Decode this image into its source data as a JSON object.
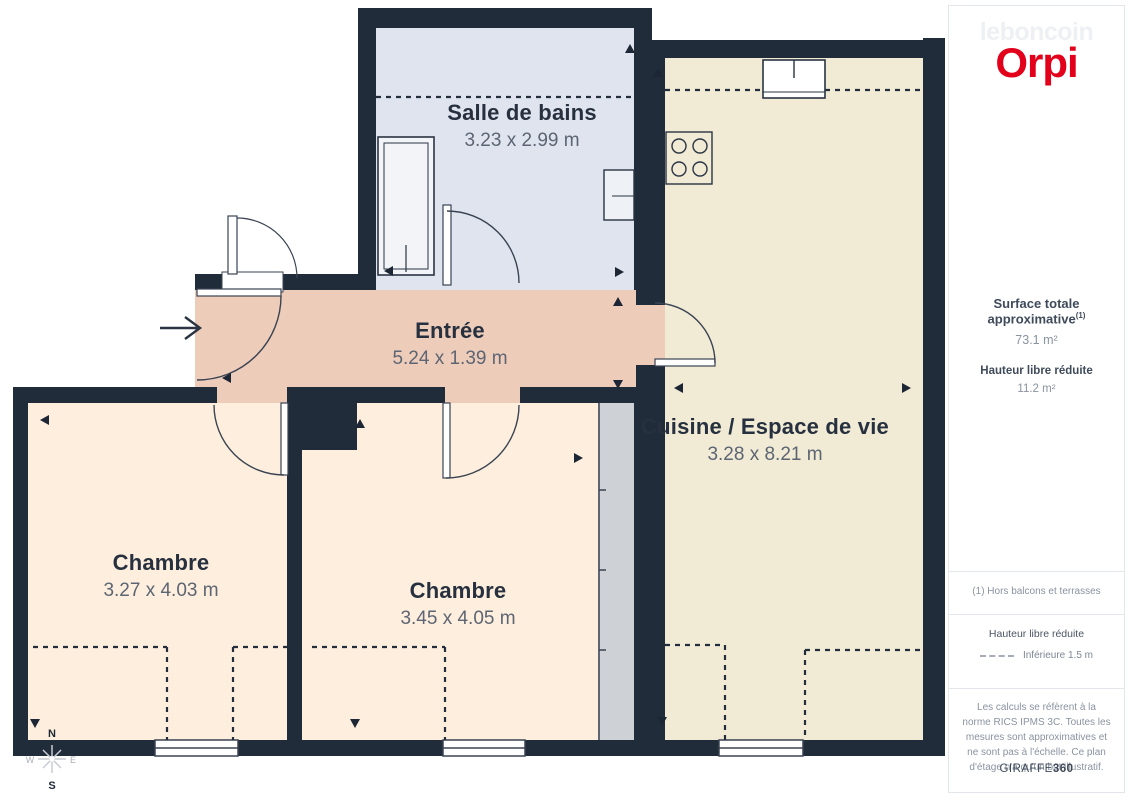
{
  "header": {
    "leboncoin": "leboncoin",
    "orpi": "Orpi"
  },
  "sidebar": {
    "surface_label": "Surface totale approximative",
    "surface_sup": "(1)",
    "surface_value": "73.1 m²",
    "height_label": "Hauteur libre réduite",
    "height_value": "11.2 m²",
    "footnote": "(1) Hors balcons et terrasses",
    "legend_title": "Hauteur libre réduite",
    "legend_value": "Inférieure 1.5 m",
    "disclaimer": "Les calculs se réfèrent à la norme RICS IPMS 3C. Toutes les mesures sont approximatives et ne sont pas à l'échelle. Ce plan d'étage n'a qu'un but illustratif.",
    "credit_normal": "GIRAFFE",
    "credit_bold": "360"
  },
  "plan": {
    "rooms": [
      {
        "name": "Salle de bains",
        "dims": "3.23 x 2.99 m"
      },
      {
        "name": "Entrée",
        "dims": "5.24 x 1.39 m"
      },
      {
        "name": "Cuisine / Espace de vie",
        "dims": "3.28 x 8.21 m"
      },
      {
        "name": "Chambre",
        "dims": "3.27 x 4.03 m"
      },
      {
        "name": "Chambre",
        "dims": "3.45 x 4.05 m"
      }
    ],
    "compass": {
      "n": "N",
      "s": "S",
      "w": "W",
      "e": "E"
    }
  },
  "colors": {
    "wall": "#212c3b",
    "bathroom_fill": "#dfe4ee",
    "kitchen_fill": "#f1ebd5",
    "entree_fill": "#eeccba",
    "chambre_fill": "#fdeedd",
    "closet_fill": "#ced2d7",
    "orpi_red": "#e2001a"
  }
}
